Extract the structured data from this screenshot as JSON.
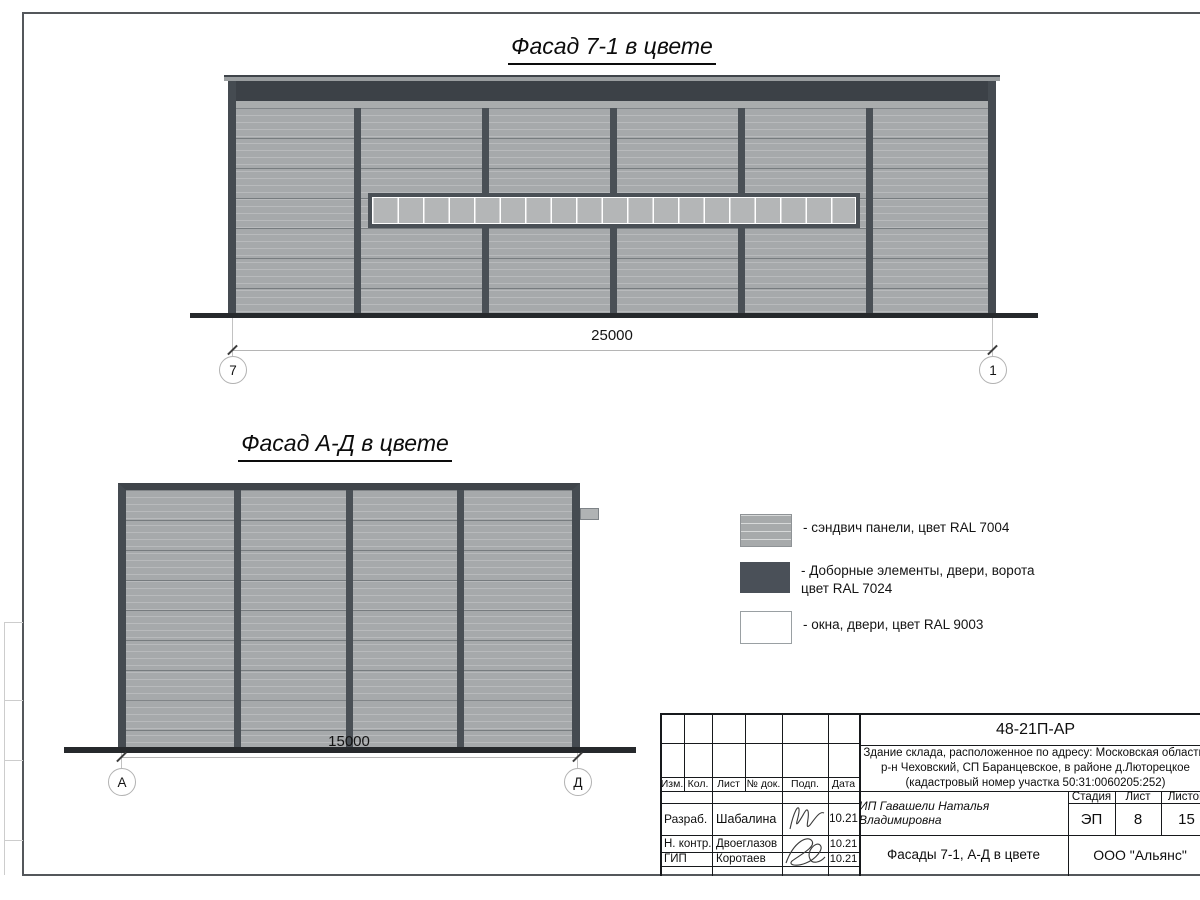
{
  "titles": {
    "facade1": "Фасад 7-1 в цвете",
    "facade2": "Фасад А-Д в цвете"
  },
  "dimensions": {
    "facade1": "25000",
    "facade2": "15000"
  },
  "grid_bubbles": {
    "facade1_left": "7",
    "facade1_right": "1",
    "facade2_left": "А",
    "facade2_right": "Д"
  },
  "legend": {
    "items": [
      {
        "label": "- сэндвич панели, цвет RAL 7004"
      },
      {
        "label1": "- Доборные элементы, двери, ворота",
        "label2": "цвет RAL 7024"
      },
      {
        "label": "- окна, двери, цвет RAL 9003"
      }
    ]
  },
  "colors": {
    "sandwich_panel": "#a6a9ab",
    "dark_elements": "#3c4147",
    "windows": "#ffffff",
    "ground": "#26292c"
  },
  "title_block": {
    "doc_number": "48-21П-АР",
    "project_line1": "Здание склада, расположенное по адресу: Московская область,",
    "project_line2": "р-н Чеховский, СП Баранцевское, в районе д.Люторецкое",
    "project_line3": "(кадастровый номер участка 50:31:0060205:252)",
    "headers": {
      "izm": "Изм.",
      "kol": "Кол.",
      "list": "Лист",
      "doc": "№ док.",
      "podp": "Подп.",
      "data": "Дата"
    },
    "rows": [
      {
        "role": "Разраб.",
        "name": "Шабалина",
        "date": "10.21"
      },
      {
        "role": "Н. контр.",
        "name": "Двоеглазов",
        "date": "10.21"
      },
      {
        "role": "ГИП",
        "name": "Коротаев",
        "date": "10.21"
      }
    ],
    "client": "ИП Гавашели Наталья Владимировна",
    "stage_header": "Стадия",
    "sheet_header": "Лист",
    "sheets_header": "Листов",
    "stage": "ЭП",
    "sheet": "8",
    "sheets": "15",
    "sheet_title": "Фасады 7-1, А-Д в цвете",
    "organization": "ООО \"Альянс\""
  }
}
